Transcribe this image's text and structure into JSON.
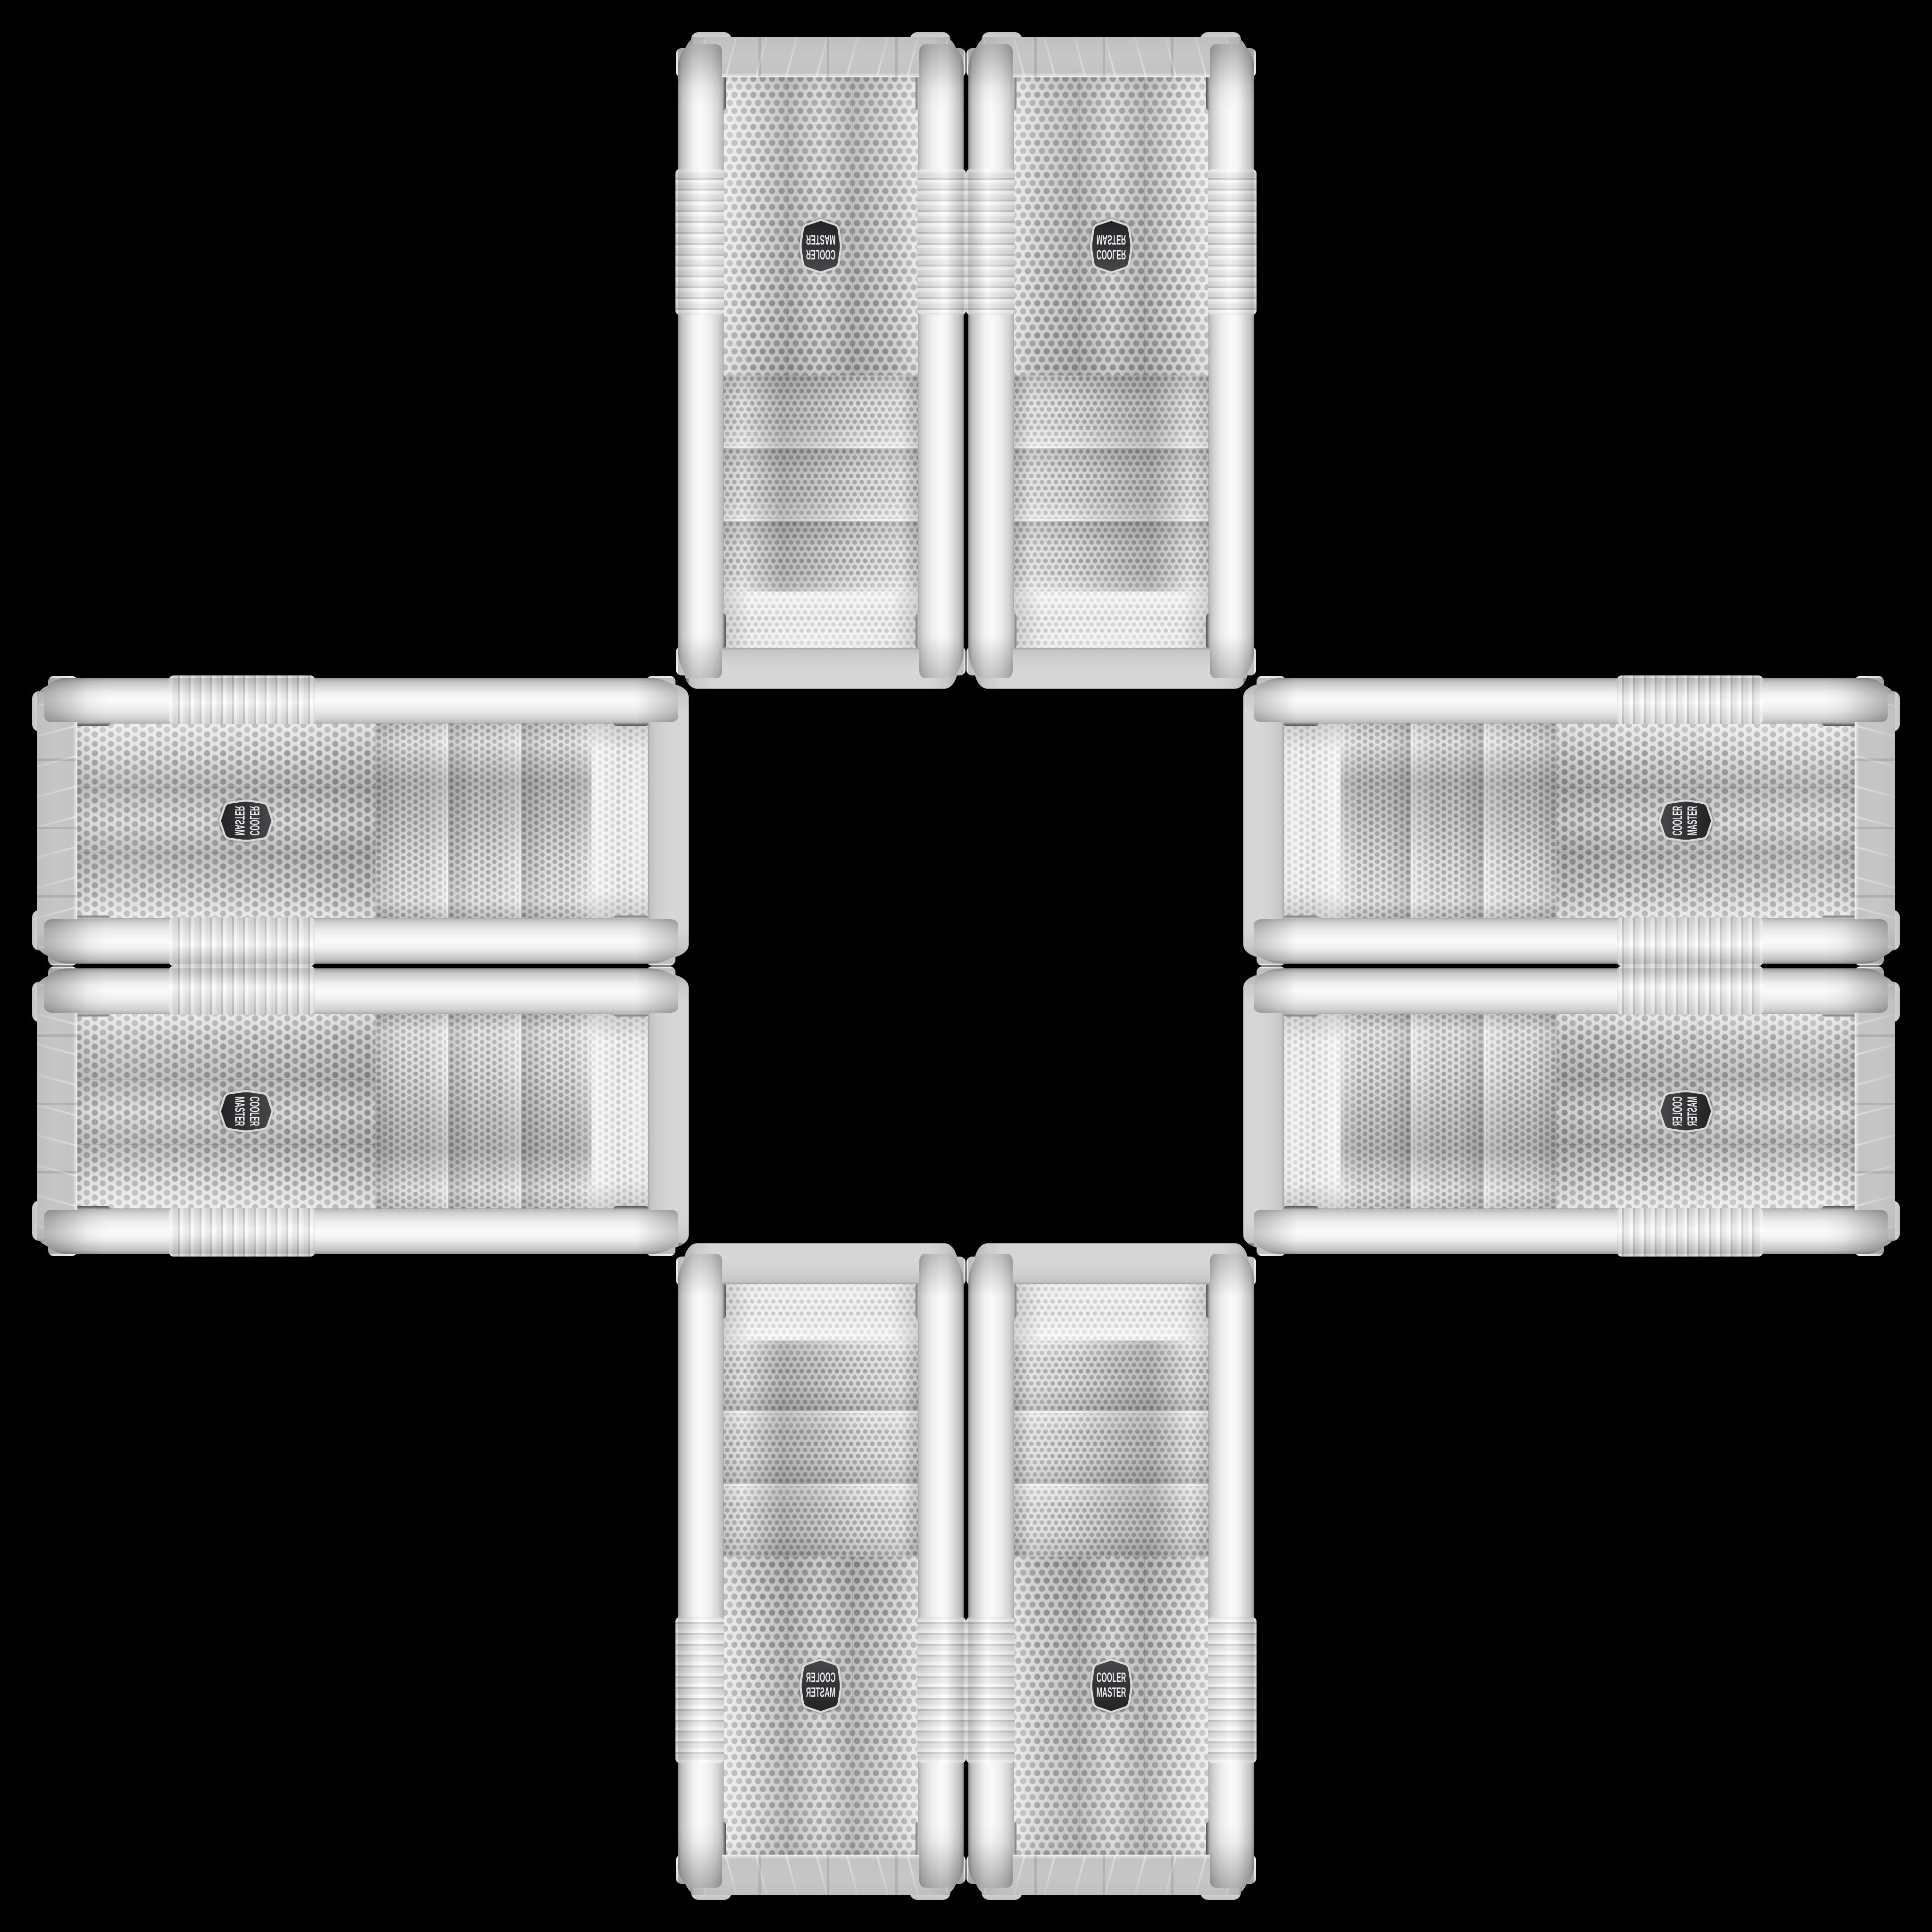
{
  "scene": {
    "description": "Eight identical white Cooler Master tower PC case front panels arranged in a plus / cross pattern on a black background, mirrored and rotated toward the empty center",
    "background_color": "#000000",
    "case_count": 8
  },
  "badge": {
    "line1": "COOLER",
    "line2": "MASTER",
    "brand": "Cooler Master",
    "fill_dark": "#39393c",
    "fill_darker": "#242426",
    "border_color": "#dedede",
    "text_color": "#ededed"
  },
  "colors": {
    "case_white": "#ececec",
    "case_highlight": "#fbfbfb",
    "case_shadow": "#c2c2c2",
    "mesh_background": "#dcdcdc",
    "mesh_hole": "#a3a3a3",
    "chrome_trim": "#8f8f8f"
  },
  "cases": [
    {
      "position": "top-left",
      "orientation": "vertical"
    },
    {
      "position": "top-right",
      "orientation": "vertical"
    },
    {
      "position": "left-top",
      "orientation": "horizontal"
    },
    {
      "position": "right-top",
      "orientation": "horizontal"
    },
    {
      "position": "left-bottom",
      "orientation": "horizontal"
    },
    {
      "position": "right-bottom",
      "orientation": "horizontal"
    },
    {
      "position": "bottom-left",
      "orientation": "vertical"
    },
    {
      "position": "bottom-right",
      "orientation": "vertical"
    }
  ]
}
